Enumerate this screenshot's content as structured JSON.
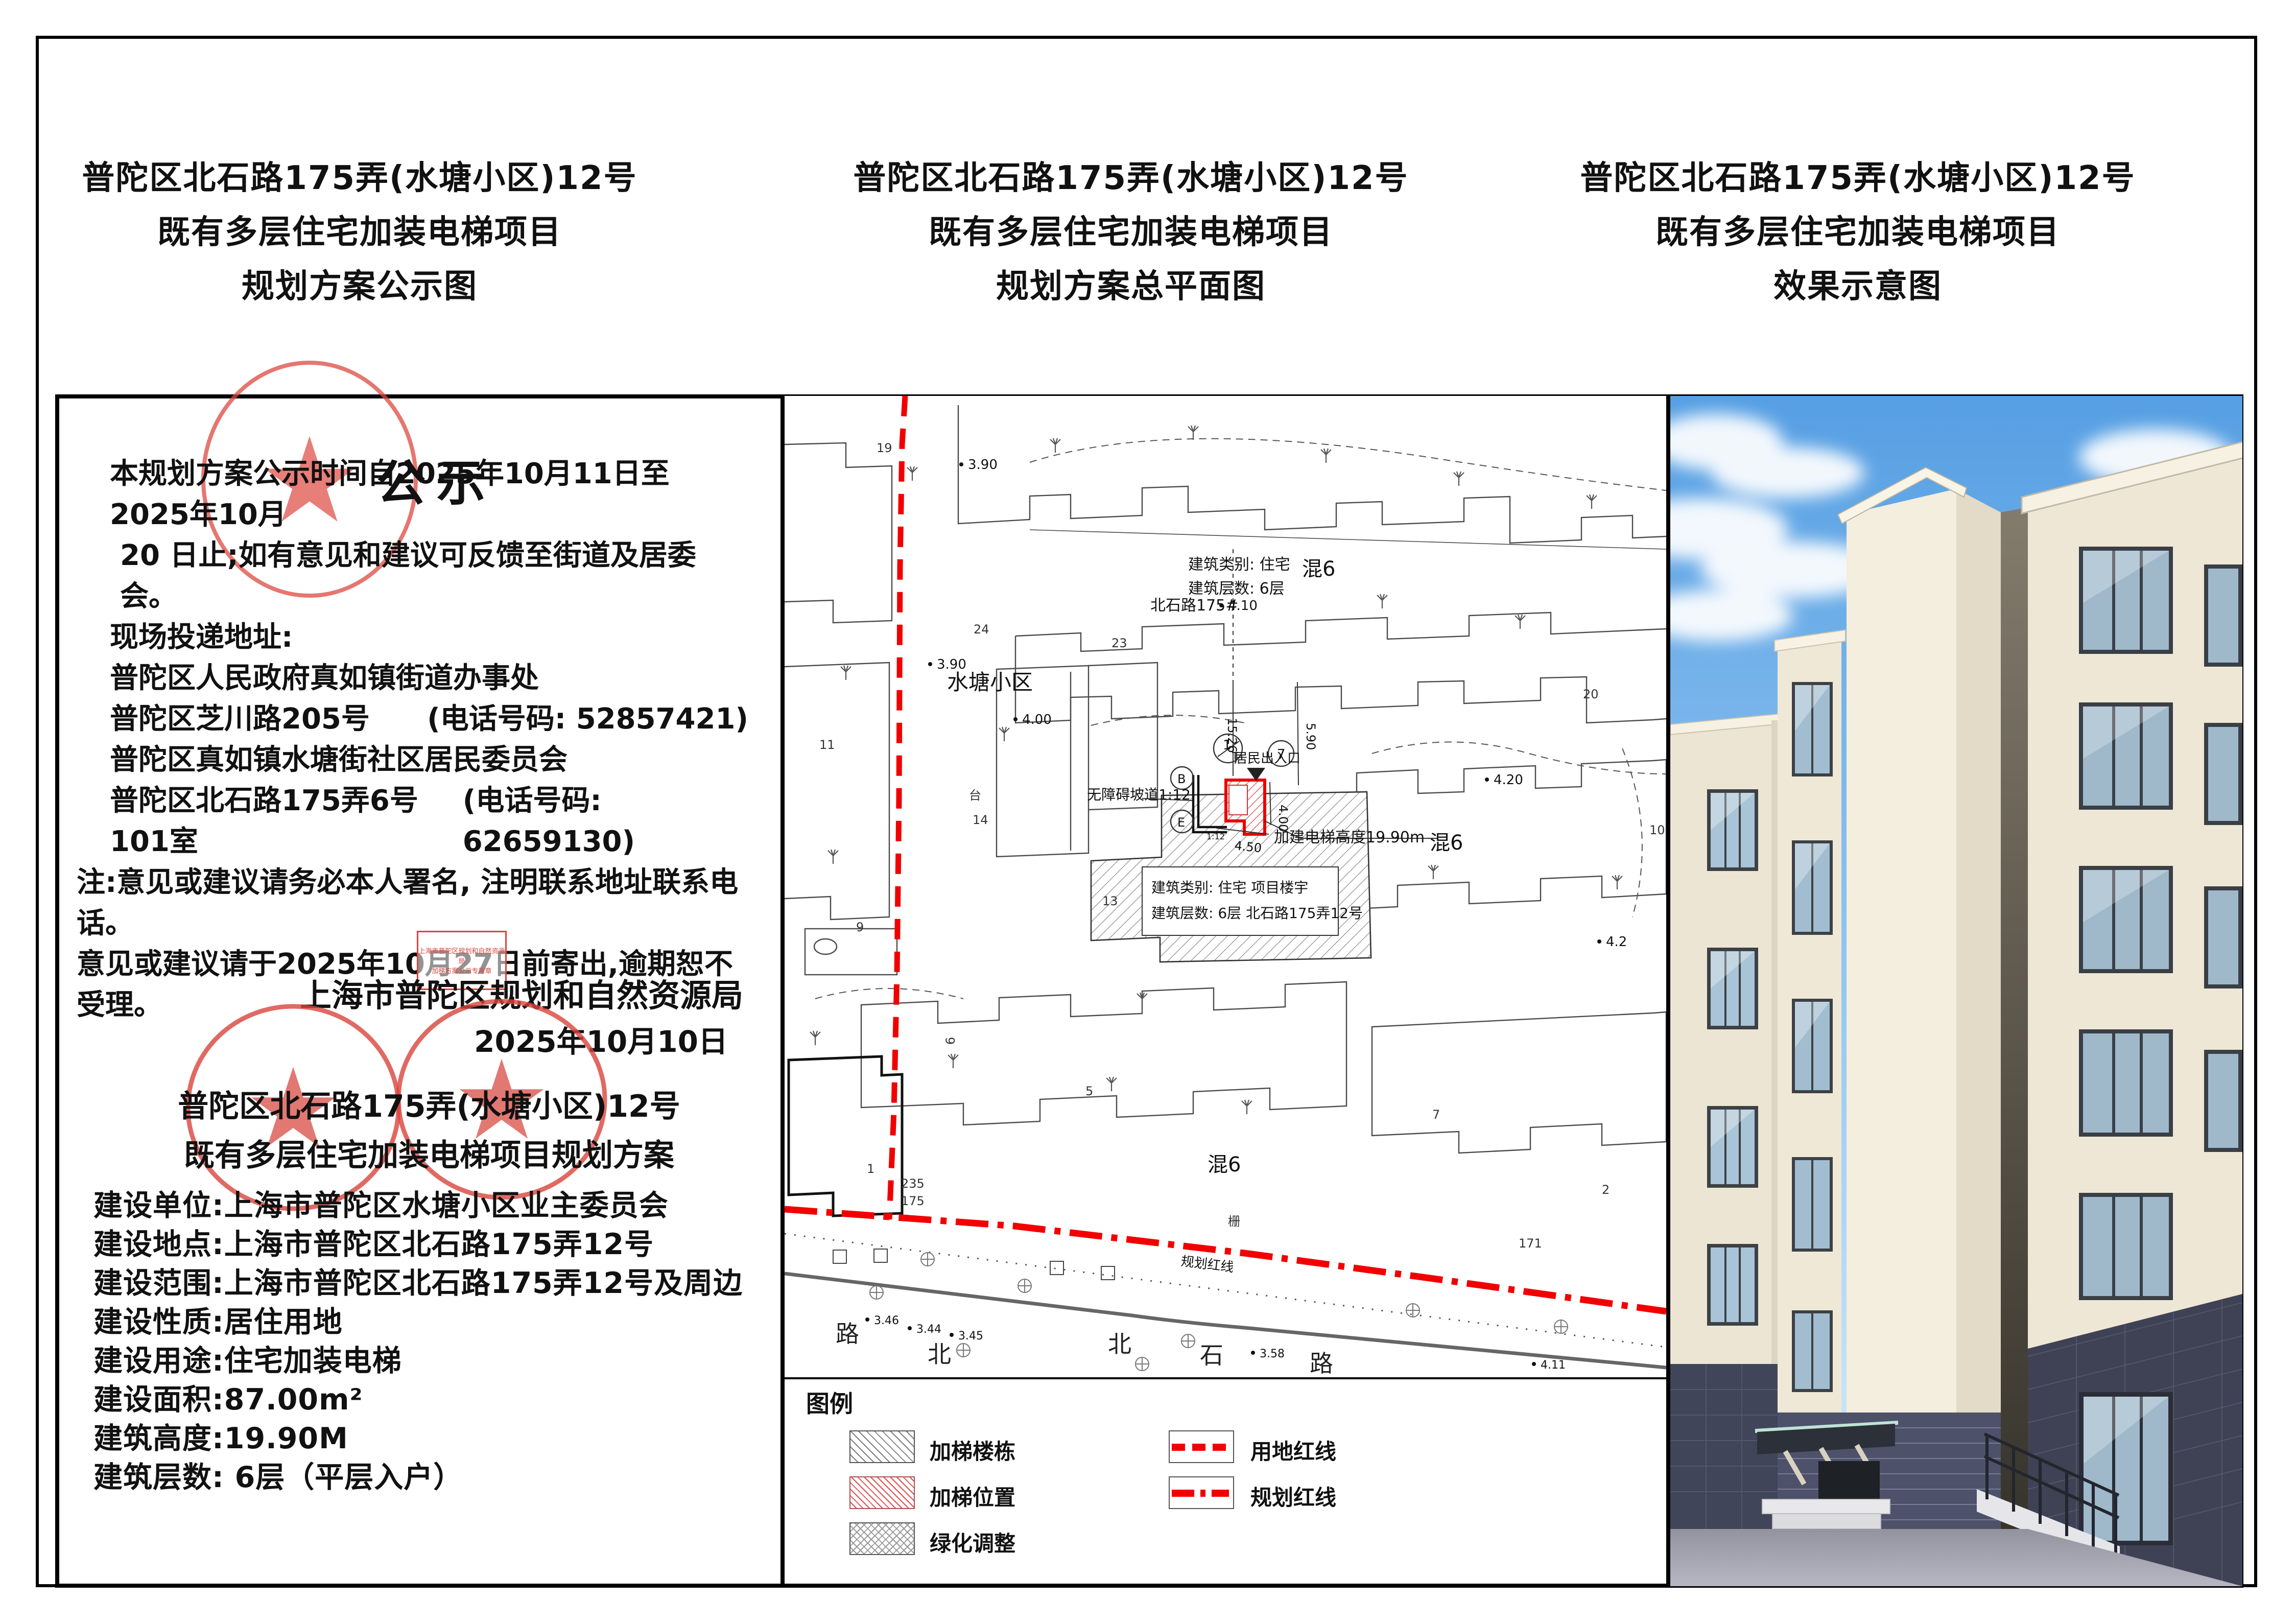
{
  "titles": {
    "left": [
      "普陀区北石路175弄(水塘小区)12号",
      "既有多层住宅加装电梯项目",
      "规划方案公示图"
    ],
    "middle": [
      "普陀区北石路175弄(水塘小区)12号",
      "既有多层住宅加装电梯项目",
      "规划方案总平面图"
    ],
    "right": [
      "普陀区北石路175弄(水塘小区)12号",
      "既有多层住宅加装电梯项目",
      "效果示意图"
    ]
  },
  "notice": {
    "heading": "公示",
    "para": [
      "本规划方案公示时间自2025年10月11日至2025年10月",
      "20 日止;如有意见和建议可反馈至街道及居委会。",
      "现场投递地址:"
    ],
    "addresses": [
      {
        "name": "普陀区人民政府真如镇街道办事处",
        "phone": ""
      },
      {
        "name": "普陀区芝川路205号",
        "phone": "(电话号码: 52857421)"
      },
      {
        "name": "普陀区真如镇水塘街社区居民委员会",
        "phone": ""
      },
      {
        "name": "普陀区北石路175弄6号101室",
        "phone": "(电话号码: 62659130)"
      }
    ],
    "note_lines": [
      "注:意见或建议请务必本人署名, 注明联系地址联系电话。",
      "意见或建议请于2025年10月27日前寄出,逾期恕不受理。"
    ],
    "agency": "上海市普陀区规划和自然资源局",
    "date": "2025年10月10日",
    "rect_stamp": [
      "上海市普陀区规划和自然资源局",
      "加梯方案公示专用章"
    ],
    "project_title": [
      "普陀区北石路175弄(水塘小区)12号",
      "既有多层住宅加装电梯项目规划方案"
    ],
    "info": [
      "建设单位:上海市普陀区水塘小区业主委员会",
      "建设地点:上海市普陀区北石路175弄12号",
      "建设范围:上海市普陀区北石路175弄12号及周边",
      "建设性质:居住用地",
      "建设用途:住宅加装电梯",
      "建设面积:87.00m²",
      "建筑高度:19.90M",
      "建筑层数: 6层（平层入户）"
    ]
  },
  "siteplan": {
    "estate_name": "水塘小区",
    "road_block_label": "北石路175#",
    "building_annotation": {
      "line1": "建筑类别: 住宅",
      "line2": "建筑层数: 6层"
    },
    "project_annotation": {
      "line1": "建筑类别: 住宅  项目楼宇",
      "line2": "建筑层数: 6层   北石路175弄12号"
    },
    "elevator_height": "加建电梯高度19.90m",
    "ramp_label": "无障碍坡道1:12",
    "ramp_small": "1:12",
    "entrance_label": "居民出入口",
    "red_line_label": "规划红线",
    "mix_labels": [
      "混6",
      "混6",
      "混6"
    ],
    "road_chars": [
      "北",
      "石",
      "路"
    ],
    "road_chars_left": [
      "路",
      "北"
    ],
    "elevations": [
      "3.90",
      "3.90",
      "4.00",
      "4.10",
      "4.20",
      "4.2",
      "3.46",
      "3.44",
      "3.45",
      "3.58",
      "4.11"
    ],
    "dims": {
      "d1": "4.50",
      "d2": "4.00",
      "d3": "5.90",
      "d4": "15.26"
    },
    "markers": {
      "m1": "1",
      "m1b": "T",
      "m2": "7",
      "m3": "B",
      "m4": "E"
    },
    "bldg_numbers": [
      "19",
      "24",
      "23",
      "20",
      "11",
      "10",
      "14",
      "台",
      "13",
      "5",
      "6",
      "1",
      "9",
      "7",
      "2",
      "171",
      "栅",
      "235",
      "175"
    ]
  },
  "legend": {
    "title": "图例",
    "items": [
      {
        "label": "加梯楼栋"
      },
      {
        "label": "加梯位置"
      },
      {
        "label": "绿化调整"
      },
      {
        "label": "用地红线"
      },
      {
        "label": "规划红线"
      }
    ]
  },
  "colors": {
    "boundary_red": "#f20000",
    "stamp_red": "#d8453c",
    "elevator_red": "#e80000",
    "sky_blue": "#5fa8e8",
    "facade_cream": "#efe8d7",
    "base_dark": "#3e4254"
  }
}
